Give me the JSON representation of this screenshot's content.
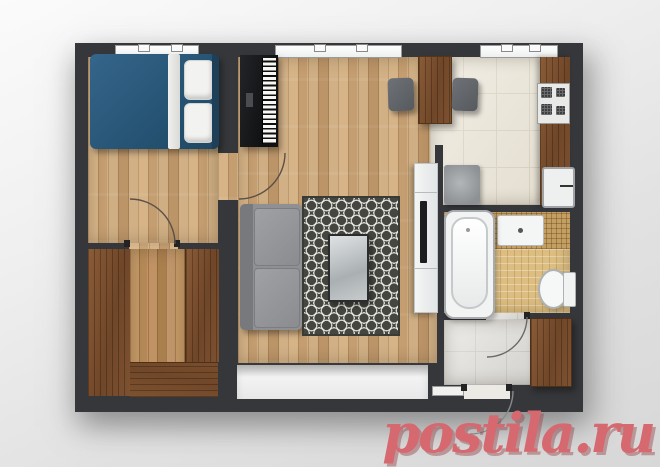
{
  "watermark": {
    "text": "postila.ru",
    "color": "#d5696f"
  },
  "plan": {
    "type": "apartment-floor-plan-top-view",
    "rooms": [
      {
        "name": "bedroom",
        "floor": "light-oak-parquet",
        "furniture": [
          "double-bed-blue",
          "white-pillows",
          "digital-piano"
        ]
      },
      {
        "name": "walk-in-closet",
        "floor": "oak-parquet",
        "furniture": [
          "wardrobe-left",
          "wardrobe-right",
          "wardrobe-bottom"
        ]
      },
      {
        "name": "living-room",
        "floor": "light-oak-parquet",
        "furniture": [
          "gray-sofa",
          "trellis-pattern-rug",
          "glass-coffee-table",
          "tv-on-white-console",
          "wooden-bar-table",
          "gray-stool-left",
          "gray-stool-right"
        ]
      },
      {
        "name": "kitchen",
        "floor": "cream-ceramic-tile",
        "furniture": [
          "wood-counter",
          "gas-stove-4-burners",
          "kitchen-sink",
          "washing-machine"
        ]
      },
      {
        "name": "bathroom",
        "floor": "gold-mosaic-tile",
        "furniture": [
          "bathtub",
          "vanity-sink",
          "toilet"
        ]
      },
      {
        "name": "entry-hallway",
        "floor": "gray-stone-tile",
        "furniture": [
          "shoe-wardrobe"
        ]
      }
    ],
    "windows_count": 5,
    "doors_count": 4
  },
  "palette": {
    "background": "#e7e7e7",
    "wall": "#35373a",
    "oak_floor": "#cdaa7e",
    "dark_wood": "#7b5130",
    "kitchen_tile": "#ebe5d6",
    "bath_tile": "#dcbe83",
    "hall_tile": "#d9d7d2",
    "bed_blue": "#2d5878",
    "sofa_gray": "#8f9094",
    "rug_charcoal": "#45463f",
    "watermark_red": "#d5696f"
  }
}
